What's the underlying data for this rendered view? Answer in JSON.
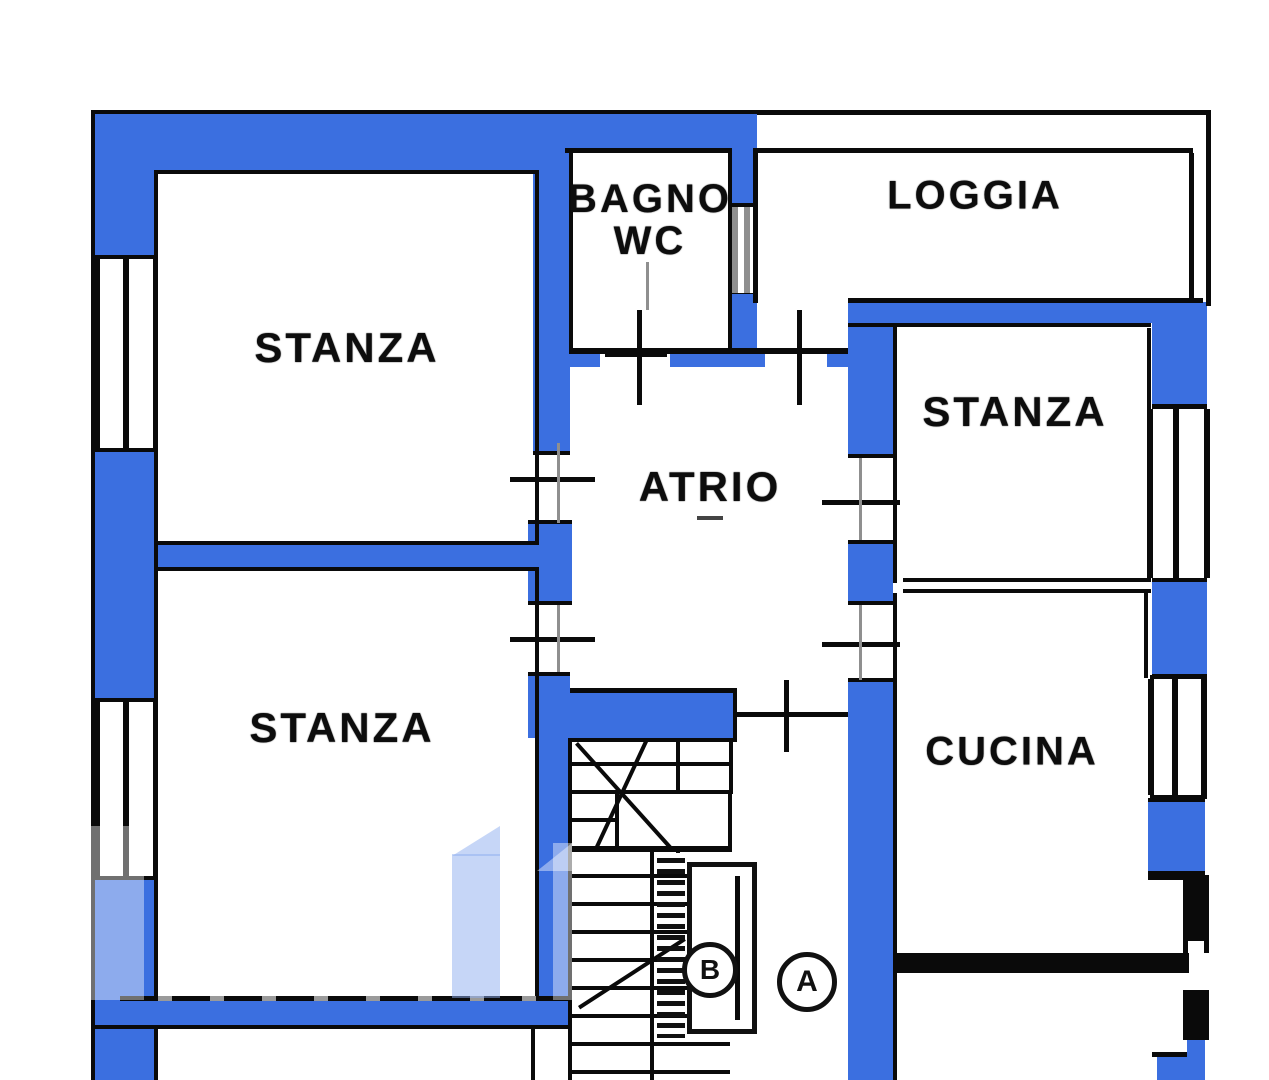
{
  "plan": {
    "rooms": [
      {
        "id": "stanza-top-left",
        "label": "STANZA"
      },
      {
        "id": "stanza-bottom-left",
        "label": "STANZA"
      },
      {
        "id": "stanza-right",
        "label": "STANZA"
      },
      {
        "id": "bagno-wc",
        "label_line1": "BAGNO",
        "label_line2": "WC"
      },
      {
        "id": "loggia",
        "label": "LOGGIA"
      },
      {
        "id": "atrio",
        "label": "ATRIO"
      },
      {
        "id": "cucina",
        "label": "CUCINA"
      }
    ],
    "unit_markers": [
      {
        "id": "unit-b",
        "label": "B"
      },
      {
        "id": "unit-a",
        "label": "A"
      }
    ],
    "colors": {
      "highlight_wall": "#3b6fe0",
      "line": "#0a0a0a",
      "opening_line": "#8f8f8f",
      "watermark": "#8daef0",
      "background": "#ffffff"
    }
  }
}
